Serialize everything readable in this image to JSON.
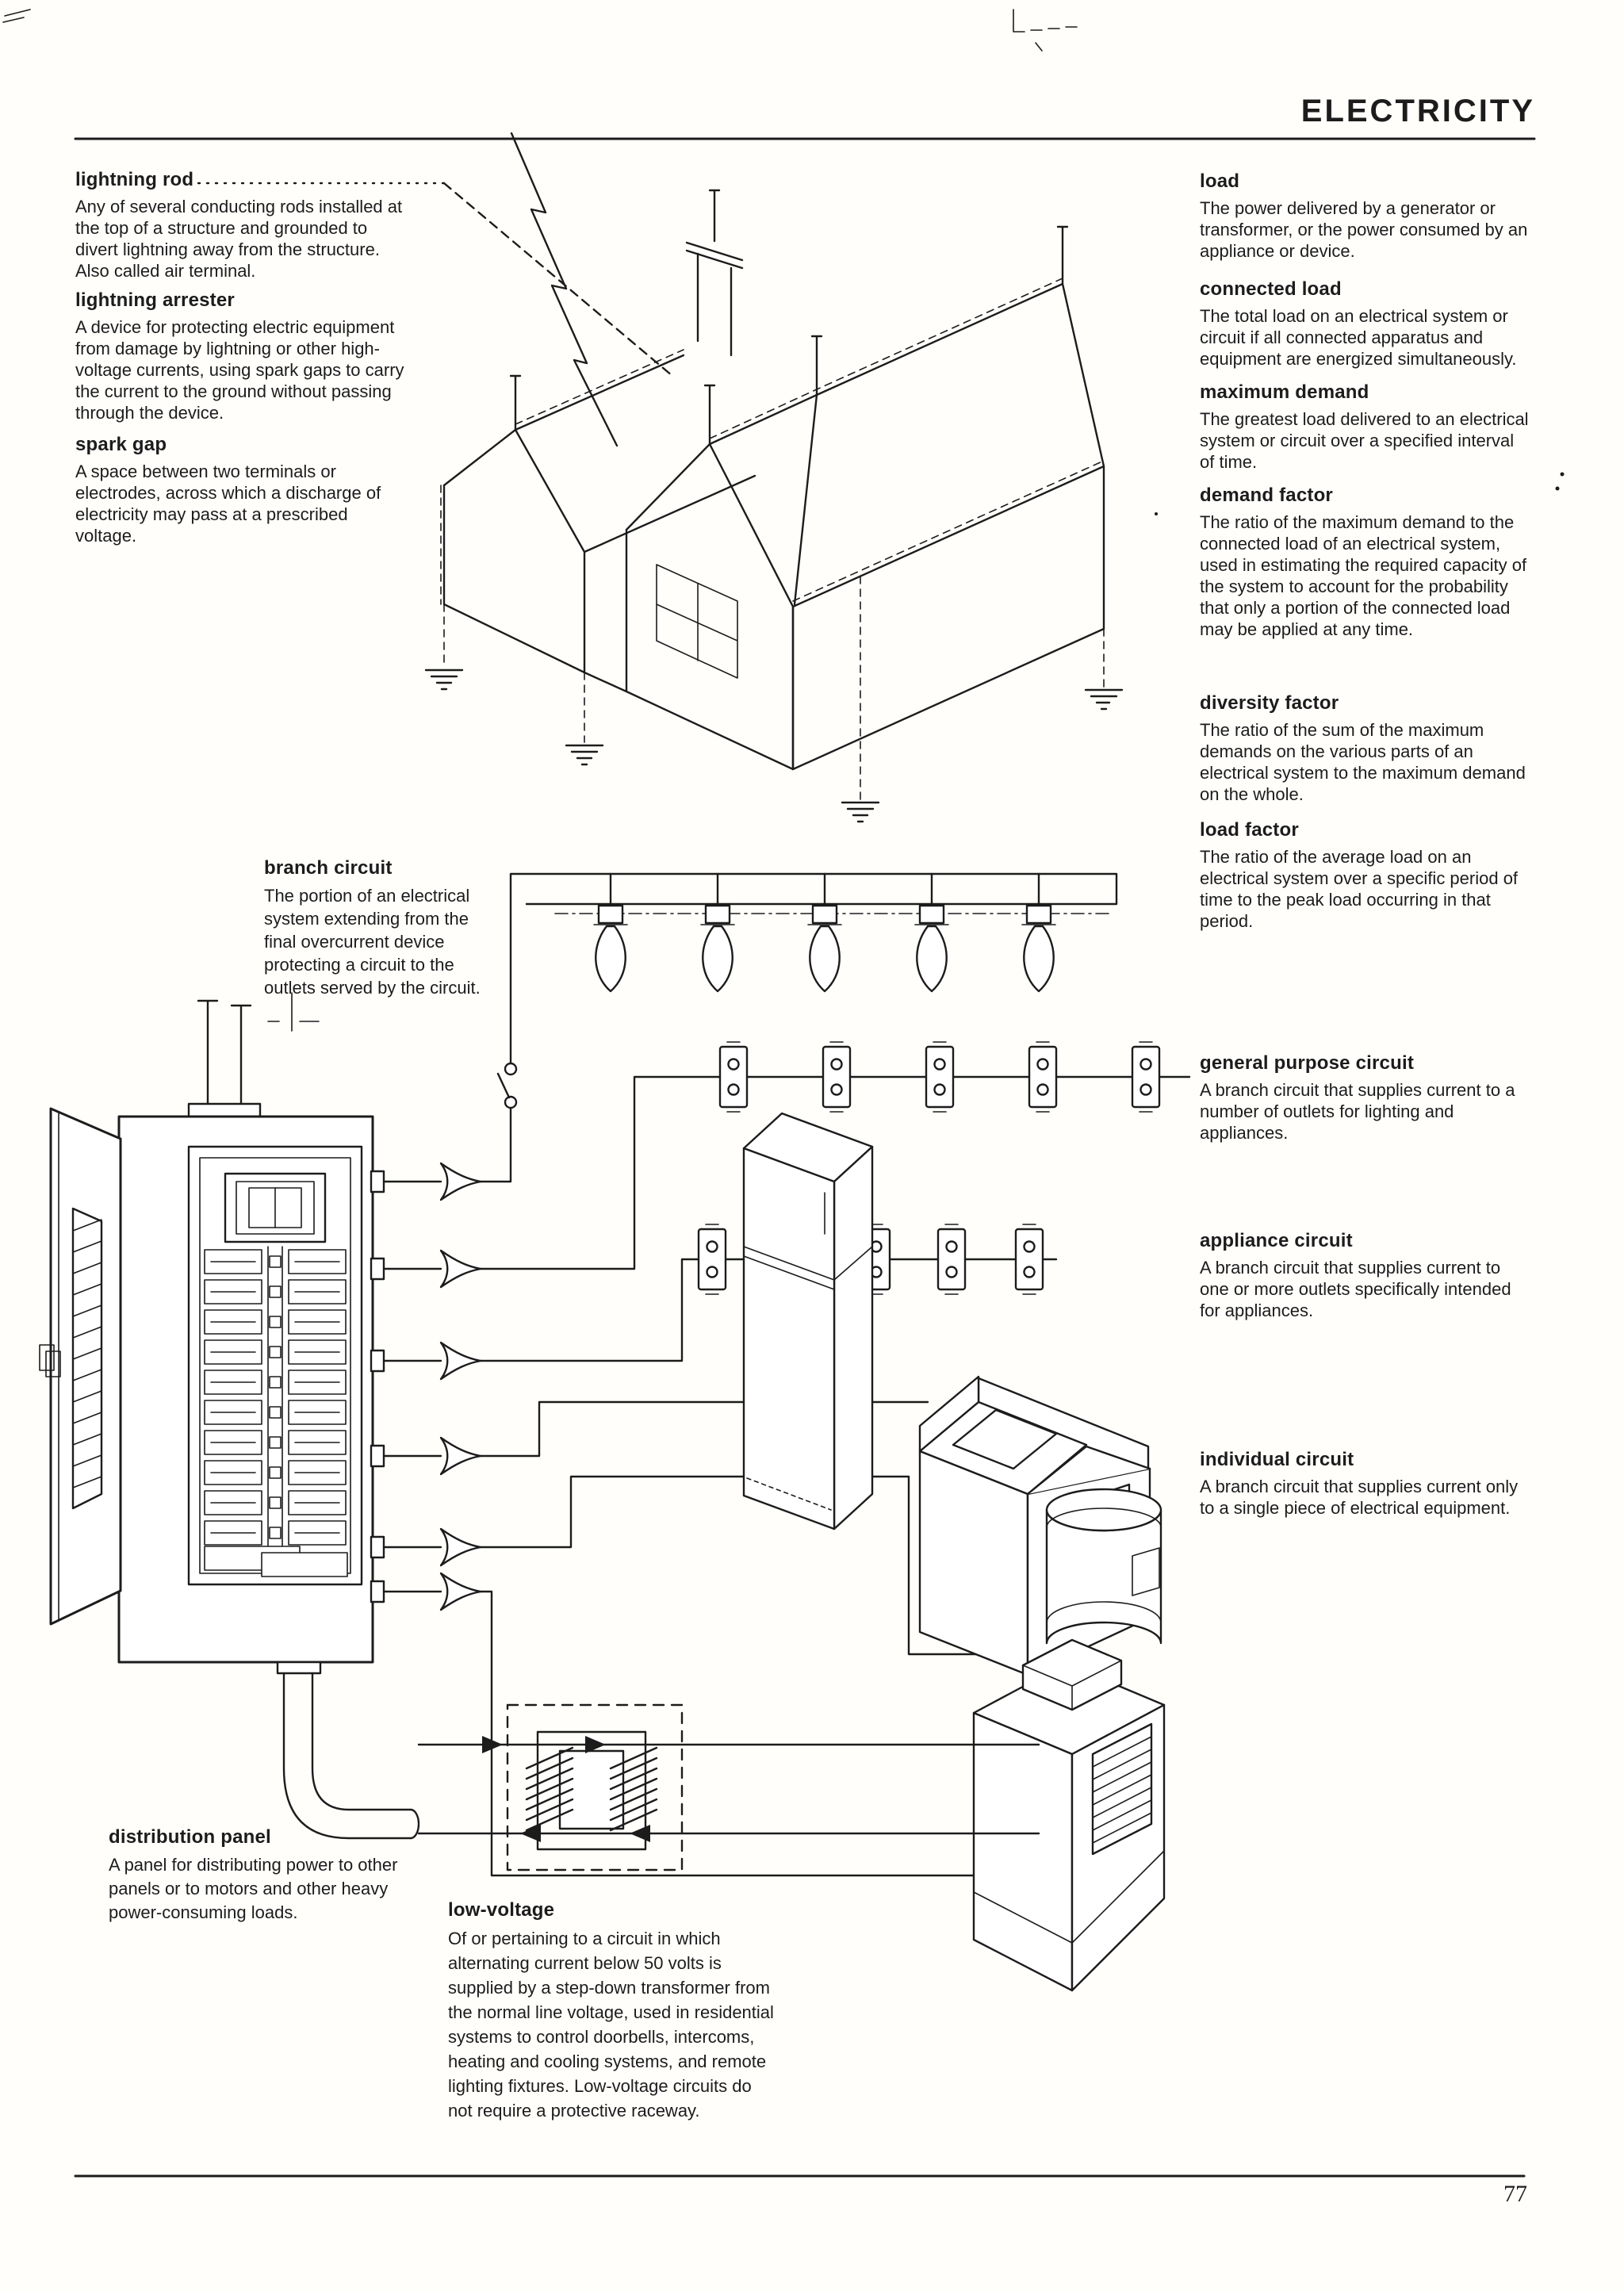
{
  "page": {
    "header_title": "ELECTRICITY",
    "page_number": "77"
  },
  "colors": {
    "ink": "#1c1c1c",
    "paper": "#fffefb"
  },
  "terms": {
    "lightning_rod": {
      "title": "lightning rod",
      "body": "Any of several conducting rods installed at\nthe top of a structure and grounded to\ndivert lightning away from the structure.\nAlso called air terminal."
    },
    "lightning_arrester": {
      "title": "lightning arrester",
      "body": "A device for protecting electric equipment\nfrom damage by lightning or other high-\nvoltage currents, using spark gaps to carry\nthe current to the ground without passing\nthrough the device."
    },
    "spark_gap": {
      "title": "spark gap",
      "body": "A space between two terminals or\nelectrodes, across which a discharge of\nelectricity may pass at a prescribed\nvoltage."
    },
    "load": {
      "title": "load",
      "body": "The power delivered by a generator or\ntransformer, or the power consumed by an\nappliance or device."
    },
    "connected_load": {
      "title": "connected load",
      "body": "The total load on an electrical system or\ncircuit if all connected apparatus and\nequipment are energized simultaneously."
    },
    "maximum_demand": {
      "title": "maximum demand",
      "body": "The greatest load delivered to an electrical\nsystem or circuit over a specified interval\nof time."
    },
    "demand_factor": {
      "title": "demand factor",
      "body": "The ratio of the maximum demand to the\nconnected load of an electrical system,\nused in estimating the required capacity of\nthe system to account for the probability\nthat only a portion of the connected load\nmay be applied at any time."
    },
    "diversity_factor": {
      "title": "diversity factor",
      "body": "The ratio of the sum of the maximum\ndemands on the various parts of an\nelectrical system to the maximum demand\non the whole."
    },
    "load_factor": {
      "title": "load factor",
      "body": "The ratio of the average load on an\nelectrical system over a specific period of\ntime to the peak load occurring in that\nperiod."
    },
    "branch_circuit": {
      "title": "branch circuit",
      "body": "The portion of an electrical\nsystem extending from the\nfinal overcurrent device\nprotecting a circuit to the\noutlets served by the circuit."
    },
    "general_purpose_circuit": {
      "title": "general purpose circuit",
      "body": "A branch circuit that supplies current to a\nnumber of outlets for lighting and\nappliances."
    },
    "appliance_circuit": {
      "title": "appliance circuit",
      "body": "A branch circuit that supplies current to\none or more outlets specifically intended\nfor appliances."
    },
    "individual_circuit": {
      "title": "individual circuit",
      "body": "A branch circuit that supplies current only\nto a single piece of electrical equipment."
    },
    "distribution_panel": {
      "title": "distribution panel",
      "body": "A panel for distributing power to other\npanels or to motors and other heavy\npower-consuming loads."
    },
    "low_voltage": {
      "title": "low-voltage",
      "body": "Of or pertaining to a circuit in which\nalternating current below 50 volts is\nsupplied by a step-down transformer from\nthe normal line voltage, used in residential\nsystems to control doorbells, intercoms,\nheating and cooling systems, and remote\nlighting fixtures. Low-voltage circuits do\nnot require a protective raceway."
    }
  }
}
